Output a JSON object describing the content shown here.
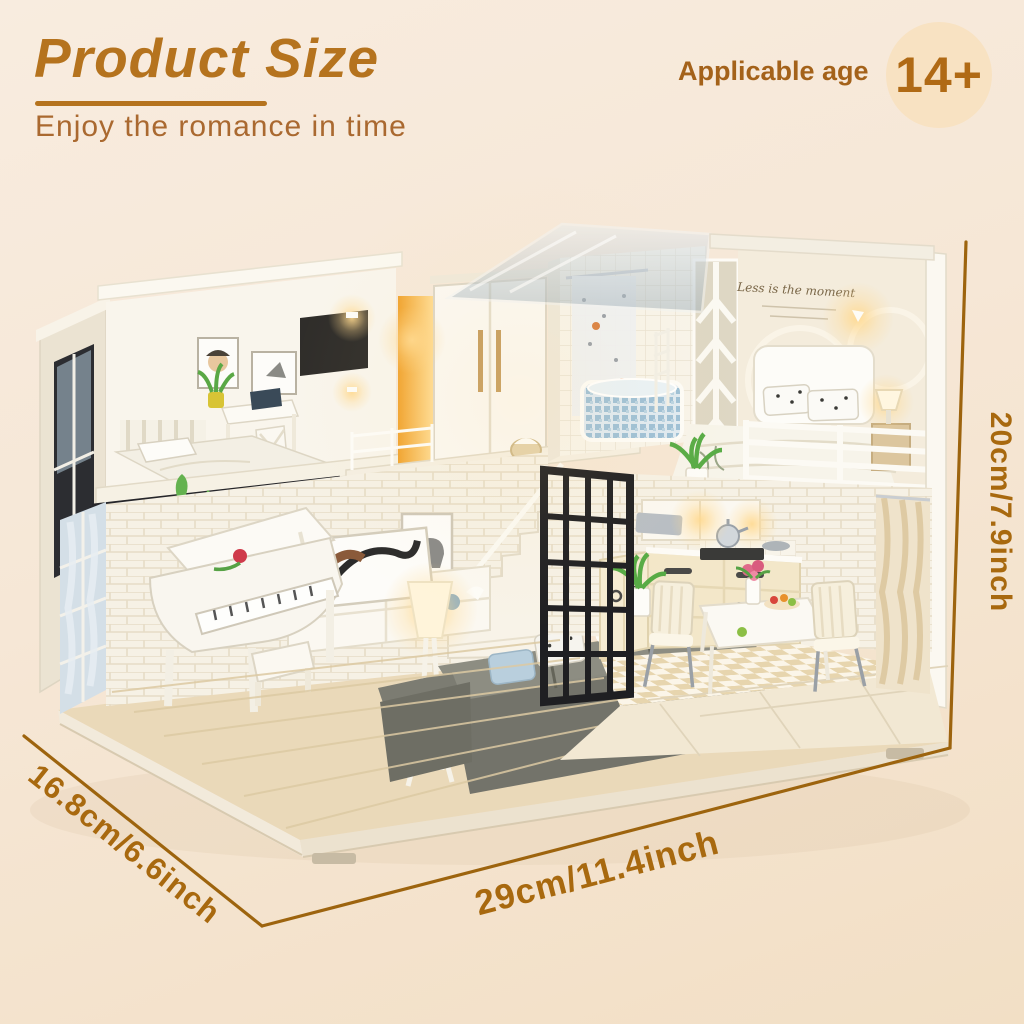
{
  "page": {
    "background_top": "#f8ecdf",
    "background_bottom": "#f2dfc5"
  },
  "header": {
    "title": "Product Size",
    "subtitle": "Enjoy the romance in time",
    "title_color": "#b5731e",
    "subtitle_color": "#aa6930"
  },
  "age_badge": {
    "label": "Applicable age",
    "value": "14+",
    "label_color": "#a4621a",
    "value_color": "#b06a15",
    "circle_color": "#f8e2c2"
  },
  "dimensions": {
    "height_label": "20cm/7.9inch",
    "width_label": "29cm/11.4inch",
    "depth_label": "16.8cm/6.6inch",
    "line_color": "#9d640e",
    "text_color": "#a8690f"
  },
  "photo": {
    "subject": "DIY miniature dollhouse: two-story lighted loft with bedroom, bathroom, kitchen, dining set, grand piano, sofa and balconies on a wooden base",
    "bedroom_wall_text": "Less is the moment"
  }
}
